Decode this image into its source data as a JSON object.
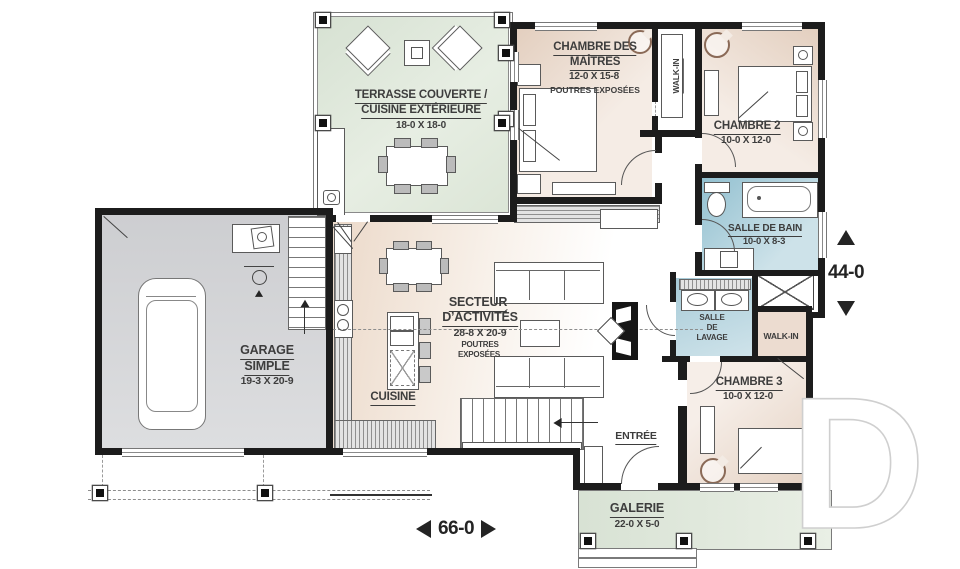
{
  "rooms": {
    "terrasse": {
      "line1": "TERRASSE COUVERTE /",
      "line2": "CUISINE EXTÉRIEURE",
      "dim": "18-0 X 18-0"
    },
    "master": {
      "line1": "CHAMBRE DES",
      "line2": "MAÎTRES",
      "dim": "12-0 X 15-8",
      "note": "POUTRES EXPOSÉES"
    },
    "master_walkin": {
      "label": "WALK-IN"
    },
    "chambre2": {
      "label": "CHAMBRE 2",
      "dim": "10-0 X 12-0"
    },
    "bain": {
      "label": "SALLE DE BAIN",
      "dim": "10-0 X 8-3"
    },
    "lavage": {
      "line1": "SALLE",
      "line2": "DE",
      "line3": "LAVAGE"
    },
    "walkin3": {
      "label": "WALK-IN"
    },
    "chambre3": {
      "label": "CHAMBRE 3",
      "dim": "10-0 X 12-0"
    },
    "garage": {
      "line1": "GARAGE",
      "line2": "SIMPLE",
      "dim": "19-3 X 20-9"
    },
    "secteur": {
      "line1": "SECTEUR",
      "line2": "D’ACTIVITÉS",
      "dim": "28-8 X 20-9",
      "note1": "POUTRES",
      "note2": "EXPOSÉES"
    },
    "cuisine": {
      "label": "CUISINE"
    },
    "entree": {
      "label": "ENTRÉE"
    },
    "galerie": {
      "label": "GALERIE",
      "dim": "22-0 X 5-0"
    }
  },
  "dimensions": {
    "overall_width": "66-0",
    "overall_height": "44-0"
  },
  "watermark": {
    "letter": "D"
  },
  "colors": {
    "wall": "#1c1c1c",
    "bedroom_floor": "#e9d9cc",
    "terrace_floor": "#dde6d8",
    "bath_floor": "#a9cbd7",
    "laundry_floor": "#b9d4dd",
    "garage_floor": "#d4d5d7",
    "gallery_floor": "#dfe8db",
    "label_text": "#3d3d3d"
  }
}
